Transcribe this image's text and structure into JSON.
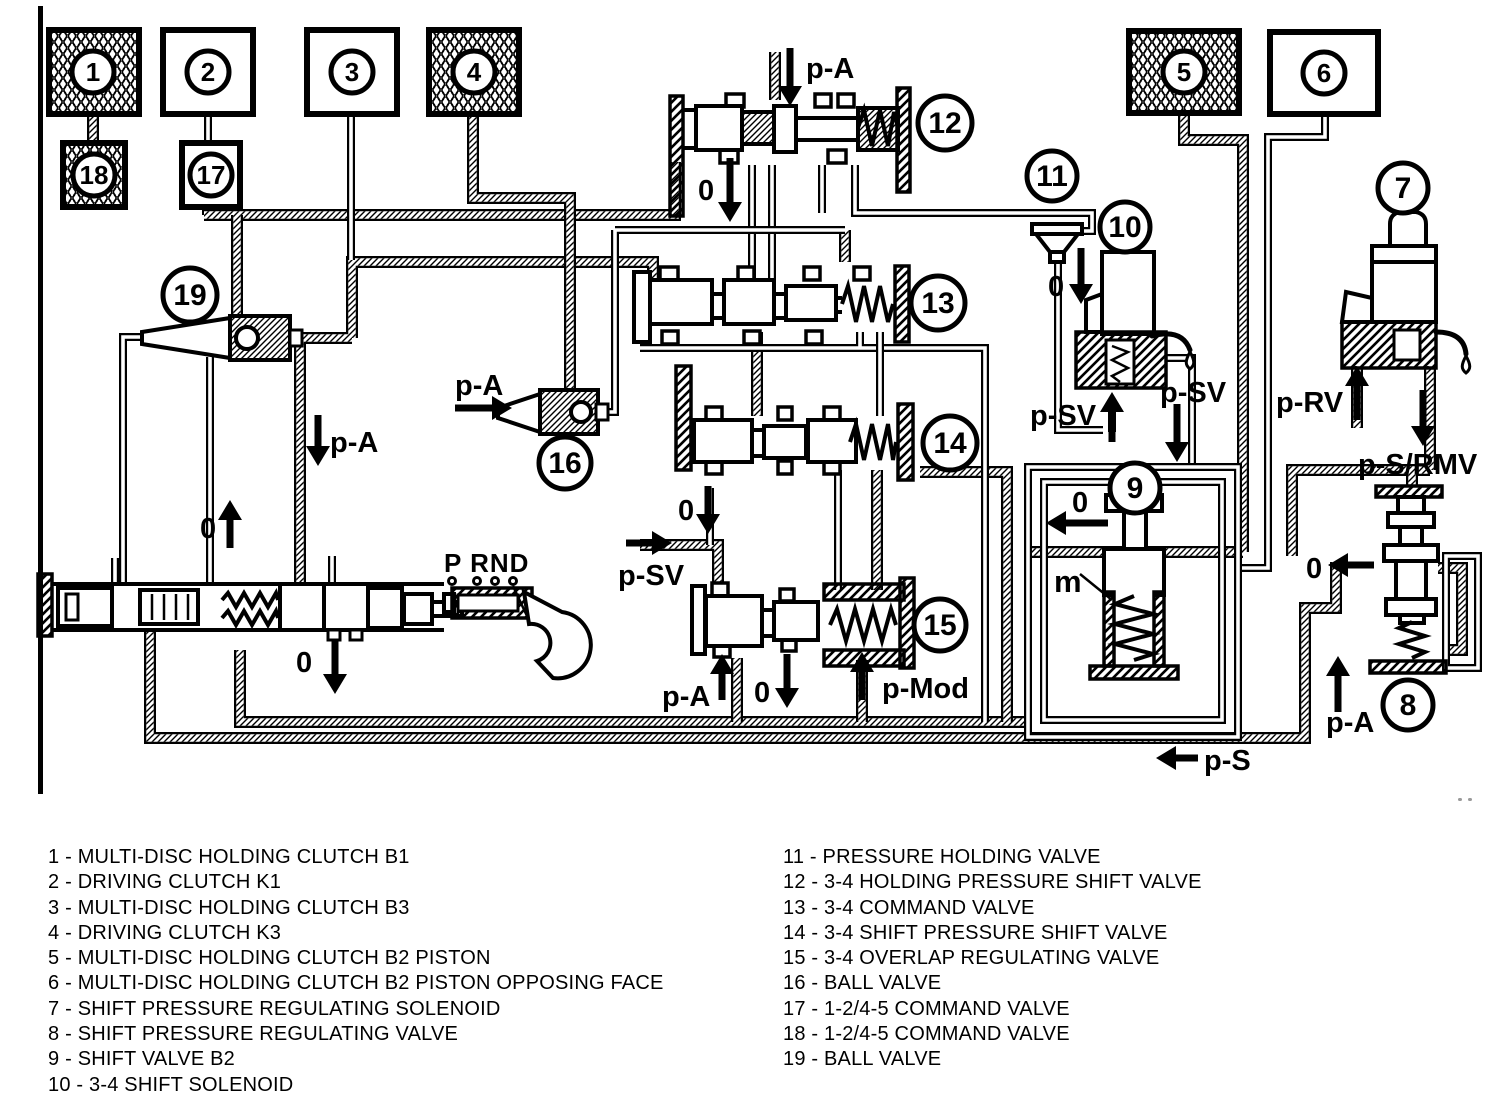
{
  "legend": {
    "left": [
      "1 - MULTI-DISC HOLDING CLUTCH B1",
      "2 - DRIVING CLUTCH K1",
      "3 - MULTI-DISC HOLDING CLUTCH B3",
      "4 - DRIVING CLUTCH K3",
      "5 - MULTI-DISC HOLDING CLUTCH B2 PISTON",
      "6 - MULTI-DISC HOLDING CLUTCH B2 PISTON OPPOSING FACE",
      "7 - SHIFT PRESSURE REGULATING SOLENOID",
      "8 - SHIFT PRESSURE REGULATING VALVE",
      "9 - SHIFT VALVE B2",
      "10 - 3-4 SHIFT SOLENOID"
    ],
    "right": [
      "11 - PRESSURE HOLDING VALVE",
      "12 - 3-4 HOLDING PRESSURE SHIFT VALVE",
      "13 - 3-4 COMMAND VALVE",
      "14 - 3-4 SHIFT PRESSURE SHIFT VALVE",
      "15 - 3-4 OVERLAP REGULATING VALVE",
      "16 - BALL VALVE",
      "17 - 1-2/4-5 COMMAND VALVE",
      "18 - 1-2/4-5 COMMAND VALVE",
      "19 - BALL VALVE"
    ]
  },
  "circle_numbers": {
    "n1": "1",
    "n2": "2",
    "n3": "3",
    "n4": "4",
    "n5": "5",
    "n6": "6",
    "n7": "7",
    "n8": "8",
    "n9": "9",
    "n10": "10",
    "n11": "11",
    "n12": "12",
    "n13": "13",
    "n14": "14",
    "n15": "15",
    "n16": "16",
    "n17": "17",
    "n18": "18",
    "n19": "19"
  },
  "labels": {
    "pa_top": "p-A",
    "zero_under_12": "0",
    "pa_left_pipe": "p-A",
    "zero_left_up": "0",
    "pa_into_16": "p-A",
    "zero_above_15": "0",
    "psv_into_15": "p-SV",
    "pa_below_15": "p-A",
    "zero_below_15": "0",
    "pmod_below_15": "p-Mod",
    "zero_under_11": "0",
    "psv_up_10": "p-SV",
    "psv_down_10": "p-SV",
    "zero_left_9": "0",
    "m_valve_9": "m",
    "prv_up_7": "p-RV",
    "psrmv_down_7": "p-S/RMV",
    "zero_left_8": "0",
    "pa_up_8": "p-A",
    "ps_bottom": "p-S",
    "zero_below_mv": "0",
    "selector_positions": "P RND"
  },
  "colors": {
    "ink": "#000000",
    "paper": "#ffffff"
  }
}
